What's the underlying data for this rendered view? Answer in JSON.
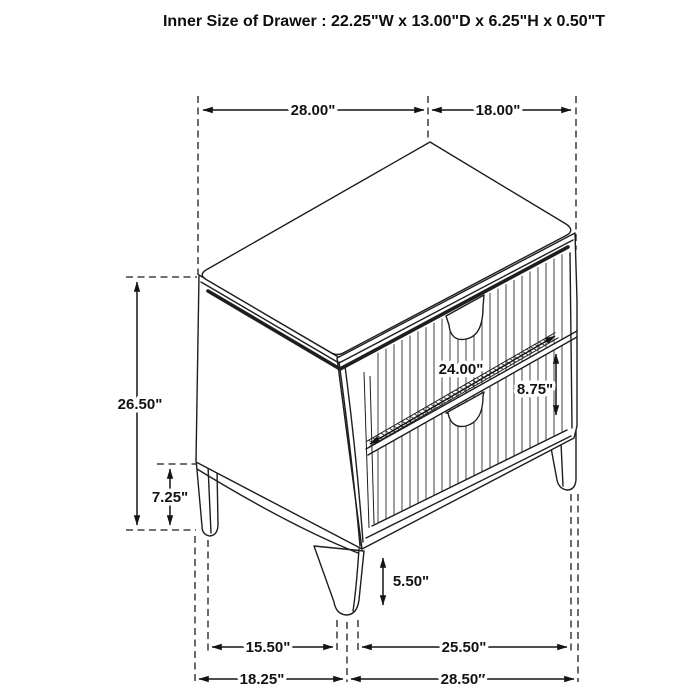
{
  "title": "Inner Size of Drawer : 22.25\"W x 13.00\"D x 6.25\"H x 0.50\"T",
  "colors": {
    "line": "#1e1e1e",
    "background": "#ffffff"
  },
  "dims": {
    "top_width": "28.00\"",
    "top_depth": "18.00\"",
    "overall_height": "26.50\"",
    "left_leg_height": "7.25\"",
    "drawer_width": "24.00\"",
    "drawer_front_height": "8.75\"",
    "front_leg_height": "5.50\"",
    "base_span_side": "15.50\"",
    "base_span_front": "25.50\"",
    "base_depth_overall": "18.25\"",
    "base_width_overall": "28.50″"
  }
}
